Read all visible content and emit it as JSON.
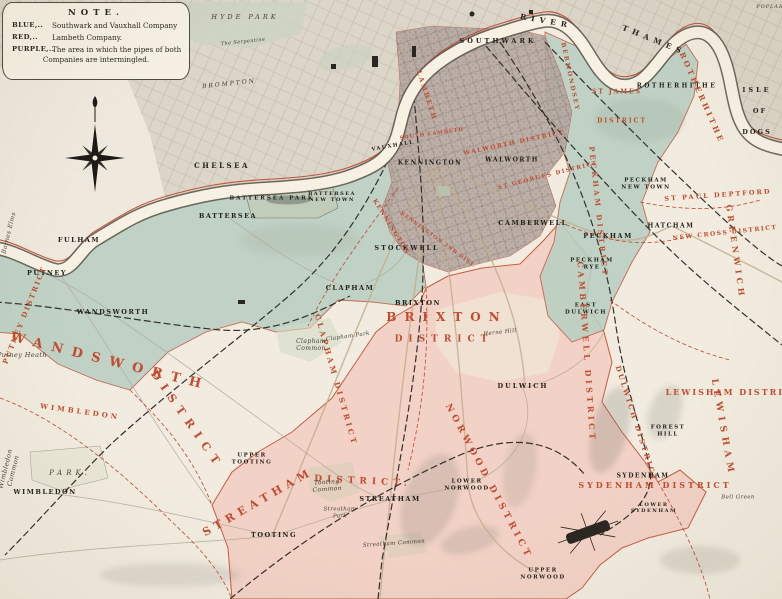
{
  "title": "Map of the water supply districts of South London",
  "note": {
    "title": "NOTE.",
    "entries": [
      {
        "key": "BLUE,..",
        "text": "Southwark and Vauxhall Company"
      },
      {
        "key": "RED,..",
        "text": "Lambeth Company."
      },
      {
        "key": "PURPLE,..",
        "text": "The area in which the pipes of both",
        "text2": "Companies are intermingled."
      }
    ]
  },
  "colors": {
    "paper": "#f1ecdf",
    "urban_gray": "#dcd6c8",
    "blue_region": "#b7cec2",
    "red_region": "#f2cfc3",
    "purple_region": "#b3a49e",
    "boundary_red": "#c0442c",
    "label_red": "#c14c30",
    "label_black": "#24211c",
    "river_fill": "#f6f1e3",
    "river_edge": "#5f5b51",
    "railway_black": "#33302a",
    "road_tan": "#c3ad8e",
    "park_green": "#c6cfba"
  },
  "labels": {
    "towns": [
      {
        "t": "SOUTHWARK",
        "x": 498,
        "y": 42,
        "s": 6.5,
        "ls": 3
      },
      {
        "t": "ROTHERHITHE",
        "x": 677,
        "y": 86,
        "s": 6,
        "ls": 2.5
      },
      {
        "t": "CHELSEA",
        "x": 222,
        "y": 166,
        "s": 7,
        "ls": 2.5
      },
      {
        "t": "KENNINGTON",
        "x": 430,
        "y": 163,
        "s": 6
      },
      {
        "t": "WALWORTH",
        "x": 512,
        "y": 160,
        "s": 6
      },
      {
        "t": "VAUXHALL",
        "x": 393,
        "y": 146,
        "s": 5,
        "r": -10
      },
      {
        "t": "BATTERSEA\nNEW TOWN",
        "x": 332,
        "y": 197,
        "s": 5
      },
      {
        "t": "BATTERSEA PARK",
        "x": 272,
        "y": 199,
        "s": 5.5,
        "ls": 2
      },
      {
        "t": "BATTERSEA",
        "x": 228,
        "y": 217,
        "s": 6.5,
        "ls": 1.5
      },
      {
        "t": "HATCHAM",
        "x": 671,
        "y": 226,
        "s": 6
      },
      {
        "t": "CAMBERWELL",
        "x": 533,
        "y": 224,
        "s": 6.5
      },
      {
        "t": "PECKHAM\nNEW TOWN",
        "x": 646,
        "y": 184,
        "s": 5.5
      },
      {
        "t": "PECKHAM",
        "x": 608,
        "y": 237,
        "s": 6.5
      },
      {
        "t": "FULHAM",
        "x": 79,
        "y": 241,
        "s": 6.5
      },
      {
        "t": "STOCKWELL",
        "x": 407,
        "y": 249,
        "s": 6.5,
        "ls": 2
      },
      {
        "t": "PECKHAM\nRYE",
        "x": 592,
        "y": 264,
        "s": 5.5
      },
      {
        "t": "PUTNEY",
        "x": 47,
        "y": 274,
        "s": 6.5
      },
      {
        "t": "CLAPHAM",
        "x": 350,
        "y": 289,
        "s": 6.5
      },
      {
        "t": "BRIXTON",
        "x": 418,
        "y": 304,
        "s": 6.5
      },
      {
        "t": "EAST\nDULWICH",
        "x": 586,
        "y": 309,
        "s": 5.5
      },
      {
        "t": "WANDSWORTH",
        "x": 113,
        "y": 313,
        "s": 6.5,
        "ls": 1.5
      },
      {
        "t": "DULWICH",
        "x": 523,
        "y": 387,
        "s": 6.5,
        "ls": 2
      },
      {
        "t": "FOREST\nHILL",
        "x": 668,
        "y": 431,
        "s": 5.5
      },
      {
        "t": "UPPER\nTOOTING",
        "x": 252,
        "y": 459,
        "s": 5.5
      },
      {
        "t": "SYDENHAM",
        "x": 643,
        "y": 476,
        "s": 6
      },
      {
        "t": "LOWER\nNORWOOD",
        "x": 467,
        "y": 485,
        "s": 5.5
      },
      {
        "t": "WIMBLEDON",
        "x": 45,
        "y": 493,
        "s": 6.5
      },
      {
        "t": "STREATHAM",
        "x": 390,
        "y": 500,
        "s": 6.5
      },
      {
        "t": "LOWER\nSYDENHAM",
        "x": 654,
        "y": 508,
        "s": 5
      },
      {
        "t": "TOOTING",
        "x": 274,
        "y": 536,
        "s": 6.5
      },
      {
        "t": "UPPER\nNORWOOD",
        "x": 543,
        "y": 574,
        "s": 5.5
      },
      {
        "t": "ISLE",
        "x": 757,
        "y": 91,
        "s": 6.5,
        "ls": 3
      },
      {
        "t": "OF",
        "x": 760,
        "y": 112,
        "s": 6.5,
        "ls": 2
      },
      {
        "t": "DOGS",
        "x": 757,
        "y": 133,
        "s": 6.5,
        "ls": 2
      }
    ],
    "districts": [
      {
        "t": "LAMBETH",
        "x": 426,
        "y": 96,
        "r": 72,
        "s": 6.5,
        "ls": 2
      },
      {
        "t": "BERMONDSEY",
        "x": 570,
        "y": 77,
        "r": 78,
        "s": 6,
        "ls": 2
      },
      {
        "t": "ST JAMES",
        "x": 617,
        "y": 92,
        "s": 6,
        "ls": 2
      },
      {
        "t": "DISTRICT",
        "x": 622,
        "y": 121,
        "s": 6,
        "ls": 2
      },
      {
        "t": "ROTHERHITHE",
        "x": 702,
        "y": 98,
        "r": 66,
        "s": 7.5,
        "ls": 3
      },
      {
        "t": "SOUTH LAMBETH",
        "x": 432,
        "y": 134,
        "r": -8,
        "s": 5,
        "ls": 1
      },
      {
        "t": "WALWORTH DISTRICT",
        "x": 514,
        "y": 143,
        "r": -12,
        "s": 6,
        "ls": 1.5
      },
      {
        "t": "ST GEORGES DISTRICT",
        "x": 548,
        "y": 176,
        "r": -14,
        "s": 5.5,
        "ls": 1.5
      },
      {
        "t": "ST PAUL DEPTFORD",
        "x": 718,
        "y": 196,
        "r": -4,
        "s": 6.5,
        "ls": 2
      },
      {
        "t": "PECKHAM DISTRICT",
        "x": 598,
        "y": 212,
        "r": 84,
        "s": 7,
        "ls": 3
      },
      {
        "t": "KENNINGTON",
        "x": 391,
        "y": 227,
        "r": 58,
        "s": 6,
        "ls": 1.5
      },
      {
        "t": "KENNINGTON 2ND DIST.",
        "x": 438,
        "y": 240,
        "r": 36,
        "s": 5,
        "ls": 1
      },
      {
        "t": "NEW CROSS DISTRICT",
        "x": 725,
        "y": 233,
        "r": -6,
        "s": 6,
        "ls": 1.5
      },
      {
        "t": "GREENWICH",
        "x": 735,
        "y": 252,
        "r": 82,
        "s": 8,
        "ls": 4
      },
      {
        "t": "PUTNEY DISTRICT",
        "x": 25,
        "y": 315,
        "r": -68,
        "s": 7,
        "ls": 2
      },
      {
        "t": "BRIXTON",
        "x": 447,
        "y": 317,
        "s": 12,
        "ls": 8
      },
      {
        "t": "DISTRICT",
        "x": 444,
        "y": 340,
        "s": 9,
        "ls": 6
      },
      {
        "t": "CAMBERWELL DISTRICT",
        "x": 586,
        "y": 352,
        "r": 86,
        "s": 8,
        "ls": 3.5
      },
      {
        "t": "WANDSWORTH",
        "x": 110,
        "y": 362,
        "r": 14,
        "s": 13,
        "ls": 9
      },
      {
        "t": "DISTRICT",
        "x": 187,
        "y": 420,
        "r": 55,
        "s": 11,
        "ls": 7
      },
      {
        "t": "CLAPHAM DISTRICT",
        "x": 336,
        "y": 380,
        "r": 74,
        "s": 7.5,
        "ls": 3
      },
      {
        "t": "LEWISHAM DISTRICT",
        "x": 733,
        "y": 393,
        "s": 8,
        "ls": 2
      },
      {
        "t": "WIMBLEDON",
        "x": 80,
        "y": 412,
        "r": 8,
        "s": 7,
        "ls": 3
      },
      {
        "t": "DULWICH DISTRICT",
        "x": 636,
        "y": 424,
        "r": 72,
        "s": 7,
        "ls": 2.5
      },
      {
        "t": "LEWISHAM",
        "x": 722,
        "y": 428,
        "r": 80,
        "s": 9,
        "ls": 5
      },
      {
        "t": "NORWOOD DISTRICT",
        "x": 488,
        "y": 482,
        "r": 62,
        "s": 9,
        "ls": 4
      },
      {
        "t": "SYDENHAM DISTRICT",
        "x": 655,
        "y": 486,
        "s": 8,
        "ls": 3
      },
      {
        "t": "STREATHAM",
        "x": 258,
        "y": 502,
        "r": -30,
        "s": 11,
        "ls": 5
      },
      {
        "t": "DISTRICT.",
        "x": 363,
        "y": 482,
        "r": 3,
        "s": 9,
        "ls": 5
      }
    ],
    "geo": [
      {
        "t": "HYDE PARK",
        "x": 245,
        "y": 18,
        "s": 6.5,
        "ls": 3
      },
      {
        "t": "The Serpentine",
        "x": 243,
        "y": 42,
        "s": 5,
        "r": -6
      },
      {
        "t": "POPLAR",
        "x": 770,
        "y": 7,
        "s": 5,
        "ls": 1
      },
      {
        "t": "BROMPTON",
        "x": 229,
        "y": 84,
        "s": 6,
        "ls": 2,
        "r": -6
      },
      {
        "t": "Barnes Elms",
        "x": 9,
        "y": 233,
        "s": 6,
        "r": -76
      },
      {
        "t": "Putney Heath",
        "x": 22,
        "y": 356,
        "s": 6.5
      },
      {
        "t": "Clapham\nCommon",
        "x": 311,
        "y": 345,
        "s": 6
      },
      {
        "t": "Clapham Park",
        "x": 348,
        "y": 337,
        "s": 5.5,
        "r": -8
      },
      {
        "t": "Herne Hill",
        "x": 500,
        "y": 333,
        "s": 5.5,
        "r": -6
      },
      {
        "t": "Wimbledon\nCommon",
        "x": 10,
        "y": 470,
        "s": 6.5,
        "r": -76
      },
      {
        "t": "PARK.",
        "x": 70,
        "y": 473,
        "s": 7,
        "ls": 4
      },
      {
        "t": "Tooting\nCommon",
        "x": 327,
        "y": 486,
        "s": 6,
        "r": -4
      },
      {
        "t": "Streatham\nPark",
        "x": 340,
        "y": 513,
        "s": 5.5
      },
      {
        "t": "Streatham Common",
        "x": 394,
        "y": 544,
        "s": 5.5,
        "r": -4
      },
      {
        "t": "Bell Green",
        "x": 738,
        "y": 498,
        "s": 5.5
      }
    ],
    "river": [
      {
        "t": "RIVER",
        "x": 546,
        "y": 21,
        "r": 10,
        "s": 7.5,
        "ls": 5
      },
      {
        "t": "THAMES",
        "x": 654,
        "y": 40,
        "r": 22,
        "s": 7.5,
        "ls": 5
      }
    ]
  },
  "compass": {
    "name": "compass-rose"
  },
  "landmarks": {
    "crystal_palace": "Crystal Palace grounds",
    "river": "River Thames"
  }
}
